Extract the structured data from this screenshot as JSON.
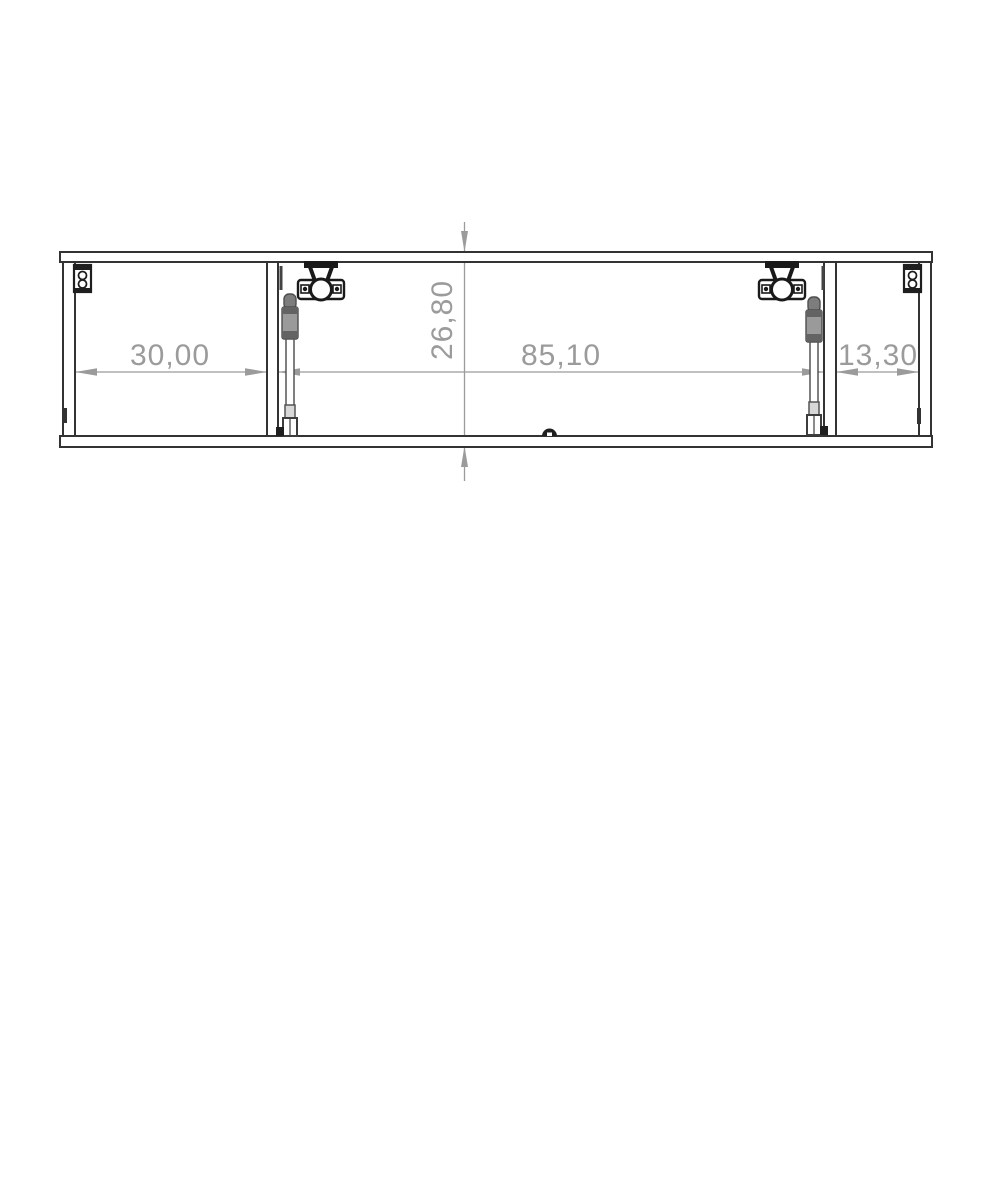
{
  "drawing": {
    "type": "furniture-technical-drawing",
    "view": "horizontal-cabinet-section",
    "colors": {
      "background": "#ffffff",
      "outline": "#333333",
      "hardware": "#1a1a1a",
      "hardware_gray": "#8d8d8d",
      "dimension": "#9b9b9b"
    },
    "dimensions": {
      "left_compartment_width": "30,00",
      "cabinet_height": "26,80",
      "middle_compartment_width": "85,10",
      "right_compartment_width": "13,30"
    },
    "components": [
      {
        "name": "top-panel"
      },
      {
        "name": "bottom-panel"
      },
      {
        "name": "left-side-panel"
      },
      {
        "name": "right-side-panel"
      },
      {
        "name": "middle-divider-panel"
      },
      {
        "name": "right-divider-panel"
      },
      {
        "name": "concealed-hinge-left"
      },
      {
        "name": "concealed-hinge-right"
      },
      {
        "name": "gas-strut-left"
      },
      {
        "name": "gas-strut-right"
      },
      {
        "name": "wall-bracket-left"
      },
      {
        "name": "wall-bracket-right"
      },
      {
        "name": "magnetic-catch"
      },
      {
        "name": "vertical-centerline"
      }
    ]
  }
}
